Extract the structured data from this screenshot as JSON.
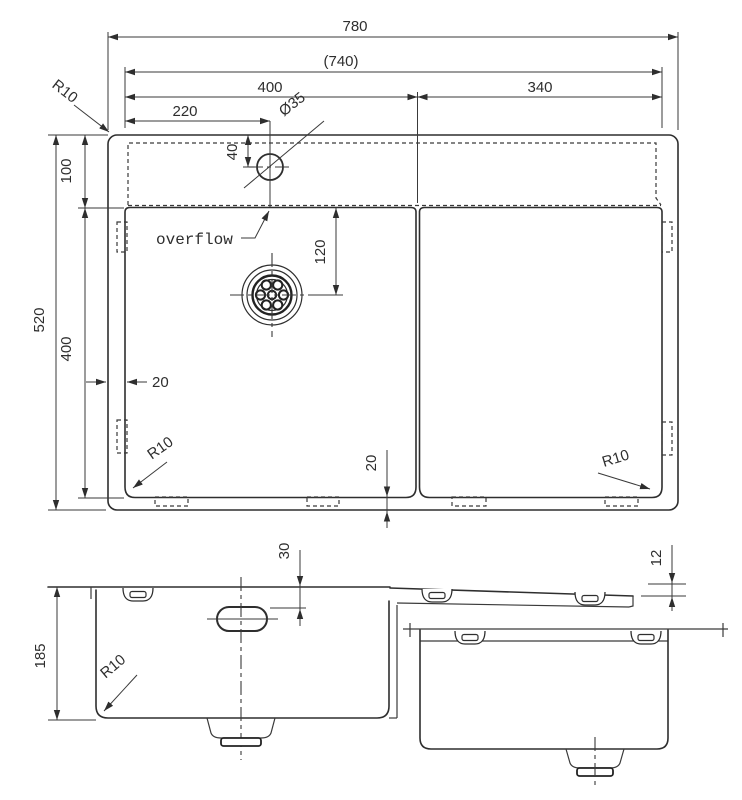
{
  "labels": {
    "top": {
      "overall_width": "780",
      "inner_width": "(740)",
      "left_bowl_width": "400",
      "right_bowl_width": "340",
      "faucet_offset": "220",
      "faucet_hole": "Ø35",
      "radius_top_left": "R10",
      "ledge_depth": "100",
      "overall_depth": "520",
      "bowl_length": "400",
      "faucet_inset": "40",
      "drain_offset": "120",
      "overflow": "overflow",
      "wall_gap": "20",
      "bottom_gap": "20",
      "radius_bottom_left": "R10",
      "radius_bottom_right": "R10"
    },
    "front": {
      "bowl_depth": "185",
      "overflow_depth": "30",
      "radius": "R10",
      "edge_drop": "12"
    }
  },
  "colors": {
    "line": "#2e2e2e",
    "background": "#ffffff"
  }
}
